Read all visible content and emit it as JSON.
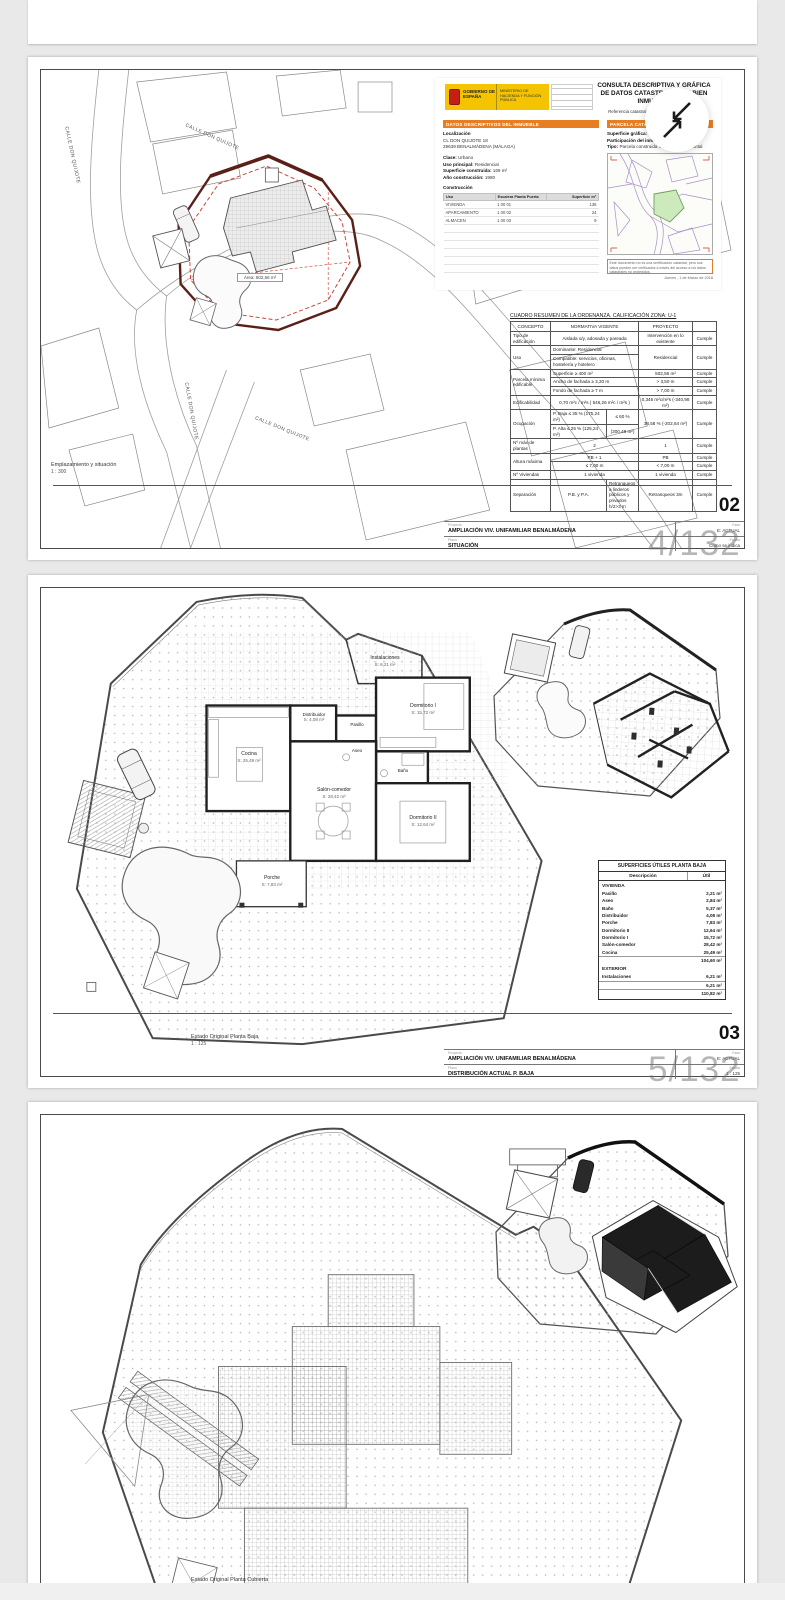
{
  "viewer": {
    "badge1": "4/132",
    "badge2": "5/132"
  },
  "sheet1": {
    "streets": {
      "s1": "CALLE DON QUIJOTE",
      "s2": "CALLE DON QUIJOTE",
      "s3": "CALLE DON QUIJOTE",
      "s4": "CALLE DON QUIJOTE"
    },
    "area_label": "Área: 502,56 m²",
    "caption": "Emplazamiento y situación",
    "caption_scale": "1 : 300",
    "catastro": {
      "title1": "CONSULTA DESCRIPTIVA Y GRÁFICA",
      "title2": "DE DATOS CATASTRALES DE BIEN INMUEBLE",
      "ref_label": "Referencia catastral:",
      "ref_value": "9656601UF5495N0001RB",
      "gob": "GOBIERNO DE ESPAÑA",
      "min": "MINISTERIO DE HACIENDA Y FUNCIÓN PÚBLICA",
      "sec1": "DATOS DESCRIPTIVOS DEL INMUEBLE",
      "loc_label": "Localización",
      "loc1": "CL DON QUIJOTE 18",
      "loc2": "29639 BENALMÁDENA (MÁLAGA)",
      "f1l": "Clase:",
      "f1v": "Urbano",
      "f2l": "Uso principal:",
      "f2v": "Residencial",
      "f3l": "Superficie construida:",
      "f3v": "169 m²",
      "f4l": "Año construcción:",
      "f4v": "1980",
      "constr_title": "Construcción",
      "ch1": "Uso",
      "ch2": "Escalera Planta Puerta",
      "ch3": "Superficie m²",
      "cr1u": "VIVIENDA",
      "cr1p": "1 00 01",
      "cr1s": "136",
      "cr2u": "APARCAMIENTO",
      "cr2p": "1 00 02",
      "cr2s": "24",
      "cr3u": "ALMACEN",
      "cr3p": "1 00 03",
      "cr3s": "9",
      "sec2": "PARCELA CATASTRAL",
      "p1l": "Superficie gráfica:",
      "p1v": "503 m²",
      "p2l": "Participación del inmueble:",
      "p2v": "100,00 %",
      "p3l": "Tipo:",
      "p3v": "Parcela construida sin división horizontal",
      "note": "Este documento no es una certificación catastral, pero sus datos pueden ser verificados a través del acceso a los datos catastrales no protegidos.",
      "date": "Jueves , 1 de Marzo de 2018"
    },
    "ordenanza": {
      "title": "CUADRO RESUMEN DE LA ORDENANZA. CALIFICACIÓN ZONA: U-1",
      "h1": "CONCEPTO",
      "h2": "NORMATIVA VIGENTE",
      "h3": "PROYECTO",
      "cumple": "Cumple",
      "r1c": "Tipo de edificación",
      "r1n": "Aislada o/y, adosada y pareada",
      "r1p": "Intervención en lo existente",
      "r2c": "Uso",
      "r2n": "Dominante: Residencial",
      "r2n2": "Compatible: servicios, oficinas, hostelería y hotelero",
      "r2p": "Residencial",
      "r3c": "Parcela mínima edificable",
      "r3n1": "Superficie ≥ 400 m²",
      "r3p1": "502,56 m²",
      "r3n2": "Ancho de fachada ≥ 3,20 m",
      "r3p2": "> 3,50 m",
      "r3n3": "Fondo de fachada ≥ 7 m",
      "r3p3": "> 7,00 m",
      "r4c": "Edificabilidad",
      "r4n": "0,70 m²c / m²s  ( 546,26 m²c / m²s )",
      "r4p": "0,346 m²c/m²s  (-340,98 m²)",
      "r5c": "Ocupación",
      "r5n1": "P. Baja ≤ 35 % (175,24 m²)",
      "r5n1b": "≤ 60 %",
      "r5n2": "P. Alta ≤ 25 % (125,24 m²)",
      "r5n2b": "(300,48 m²)",
      "r5p": "38,58 % (-202,64 m²)",
      "r6c": "Nº máx de plantas",
      "r6n": "2",
      "r6p": "1",
      "r7c": "Altura máxima",
      "r7n1": "PB + 1",
      "r7p1": "PB",
      "r7n2": "≤ 7,00 m",
      "r7p2": "< 7,00 m",
      "r8c": "Nº Viviendas",
      "r8n": "1 vivienda",
      "r8p": "1 vivienda",
      "r9c": "Separación",
      "r9n1": "P.B. y P.A.",
      "r9n2": "Retranqueos a linderos públicos y privados h/2>3 m",
      "r9p": "Retranqueos 3m"
    },
    "titleblock": {
      "num": "02",
      "proy_l": "Proyecto",
      "proy": "AMPLIACIÓN VIV. UNIFAMILIAR BENALMÁDENA",
      "fase_l": "Fase",
      "fase": "E: ACTUAL",
      "plano_l": "Plano",
      "plano": "SITUACIÓN",
      "esc_l": "Escala",
      "esc": "Como se indica"
    }
  },
  "sheet2": {
    "rooms": {
      "cocina": "Cocina",
      "cocina_s": "S: 25,49 m²",
      "salon": "Salón-comedor",
      "salon_s": "S: 28,42 m²",
      "dorm1": "Dormitorio I",
      "dorm1_s": "S: 15,72 m²",
      "dorm2": "Dormitorio II",
      "dorm2_s": "S: 12,64 m²",
      "bano": "Baño",
      "bano_s": "S: 5,37 m²",
      "aseo": "Aseo",
      "aseo_s": "S: 2,84 m²",
      "distrib": "Distribuidor",
      "distrib_s": "S: 4,08 m²",
      "pasillo": "Pasillo",
      "pasillo_s": "S: 2,21 m²",
      "porche": "Porche",
      "porche_s": "S: 7,83 m²",
      "instal": "Instalaciones",
      "instal_s": "S: 6,21 m²"
    },
    "caption": "Estado Original Planta Baja",
    "caption_scale": "1 : 125",
    "superficies": {
      "title": "SUPERFICIES ÚTILES PLANTA BAJA",
      "col1": "Descripción",
      "col2": "Útil",
      "sec1": "VIVIENDA",
      "rows": [
        [
          "Pasillo",
          "2,21 m²"
        ],
        [
          "Aseo",
          "2,84 m²"
        ],
        [
          "Baño",
          "5,37 m²"
        ],
        [
          "Distribuidor",
          "4,08 m²"
        ],
        [
          "Porche",
          "7,83 m²"
        ],
        [
          "Dormitorio II",
          "12,64 m²"
        ],
        [
          "Dormitorio I",
          "15,72 m²"
        ],
        [
          "Salón-comedor",
          "28,42 m²"
        ],
        [
          "Cocina",
          "25,49 m²"
        ]
      ],
      "sub1": "104,60 m²",
      "sec2": "EXTERIOR",
      "rows2": [
        [
          "Instalaciones",
          "6,21 m²"
        ]
      ],
      "sub2": "6,21 m²",
      "total": "110,82 m²"
    },
    "titleblock": {
      "num": "03",
      "proy_l": "Proyecto",
      "proy": "AMPLIACIÓN VIV. UNIFAMILIAR BENALMÁDENA",
      "fase_l": "Fase",
      "fase": "E: ACTUAL",
      "plano_l": "Plano",
      "plano": "DISTRIBUCIÓN ACTUAL P. BAJA",
      "esc_l": "Escala",
      "esc": "1 : 125"
    }
  },
  "sheet3": {
    "caption": "Estado Original Planta Cubierta",
    "num": "04"
  }
}
